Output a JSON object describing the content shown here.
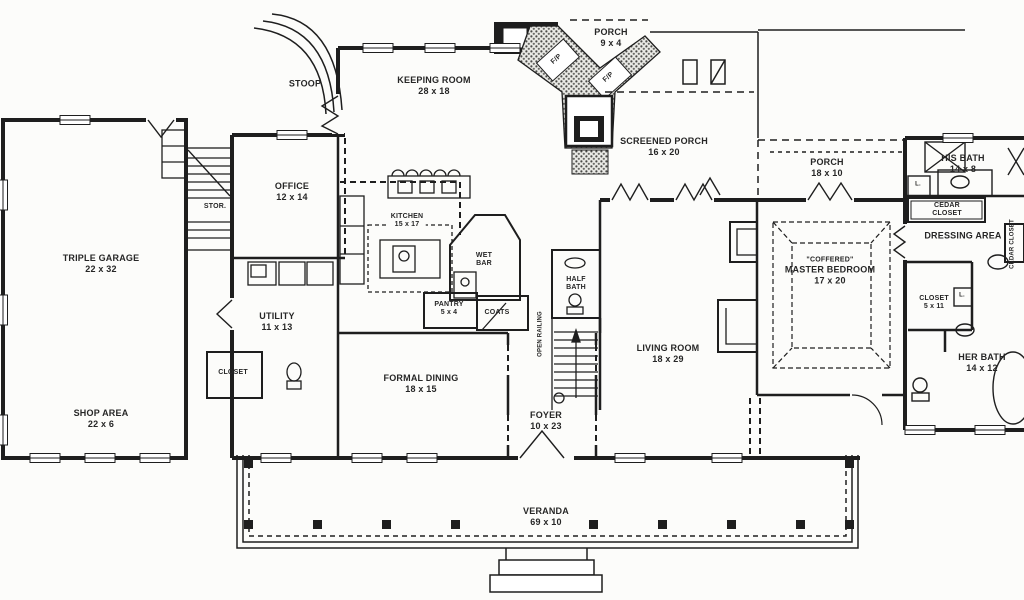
{
  "drawing": {
    "kind": "single-story house floor plan, black line art on white",
    "ink_color": "#1e1e1e",
    "background_color": "#fcfcfa"
  },
  "labels": [
    {
      "l1": "STOOP"
    },
    {
      "l1": "KEEPING ROOM",
      "l2": "28 x 18"
    },
    {
      "l1": "PORCH",
      "l2": "9 x 4"
    },
    {
      "l1": "SCREENED PORCH",
      "l2": "16 x 20"
    },
    {
      "l1": "PORCH",
      "l2": "18 x 10"
    },
    {
      "l1": "HIS BATH",
      "l2": "14 x 8"
    },
    {
      "l1": "CEDAR",
      "l2": "CLOSET"
    },
    {
      "l1": "DRESSING AREA"
    },
    {
      "l1": "CEDAR CLOSET"
    },
    {
      "l1": "OFFICE",
      "l2": "12 x 14"
    },
    {
      "l1": "STOR."
    },
    {
      "l1": "TRIPLE GARAGE",
      "l2": "22 x 32"
    },
    {
      "l1": "KITCHEN",
      "l2": "15 x 17"
    },
    {
      "l1": "WET",
      "l2": "BAR"
    },
    {
      "l1": "PANTRY",
      "l2": "5 x 4"
    },
    {
      "l1": "COATS"
    },
    {
      "l1": "HALF",
      "l2": "BATH"
    },
    {
      "l1": "UTILITY",
      "l2": "11 x 13"
    },
    {
      "l1": "CLOSET"
    },
    {
      "l1": "\"COFFERED\"",
      "l2": "MASTER BEDROOM",
      "l3": "17 x 20"
    },
    {
      "l1": "LIVING ROOM",
      "l2": "18 x 29"
    },
    {
      "l1": "CLOSET",
      "l2": "5 x 11"
    },
    {
      "l1": "HER BATH",
      "l2": "14 x 12"
    },
    {
      "l1": "FORMAL DINING",
      "l2": "18 x 15"
    },
    {
      "l1": "FOYER",
      "l2": "10 x 23"
    },
    {
      "l1": "SHOP AREA",
      "l2": "22 x 6"
    },
    {
      "l1": "VERANDA",
      "l2": "69 x 10"
    },
    {
      "l1": "F/P"
    },
    {
      "l1": "F/P"
    },
    {
      "l1": "OPEN RAILING"
    },
    {
      "l1": "L."
    },
    {
      "l1": "L."
    }
  ]
}
